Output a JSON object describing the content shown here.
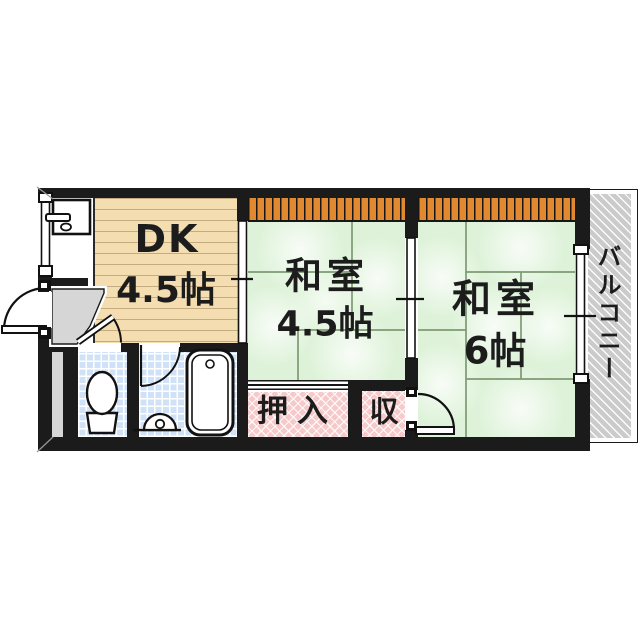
{
  "floorplan": {
    "dk": {
      "name": "DK",
      "size": "4.5帖"
    },
    "washitsu_45": {
      "name": "和室",
      "size": "4.5帖"
    },
    "washitsu_6": {
      "name": "和室",
      "size": "6帖"
    },
    "oshiire": {
      "name": "押入"
    },
    "storage": {
      "name": "収"
    },
    "balcony": {
      "name": "バルコニー"
    },
    "colors": {
      "wall": "#1b1b1b",
      "tatami_green": "#ddf2d8",
      "wood_floor_beige": "#f4ddb0",
      "closet_pink": "#f6caca",
      "tile_blue": "#cfe2f7",
      "window_band_orange": "#e2892f",
      "balcony_gray": "#cbcbcb",
      "genkan_gray": "#d6d6d6"
    },
    "icons": [
      "kitchen-sink-icon",
      "toilet-icon",
      "bathtub-icon",
      "washing-drain-icon",
      "entrance-door-icon",
      "toilet-door-icon",
      "bath-door-icon",
      "storage-door-icon",
      "window-left-icon",
      "window-right-icon",
      "sliding-partition-dk-icon",
      "sliding-partition-washitsu-icon",
      "oshiire-sliding-door-icon"
    ]
  }
}
